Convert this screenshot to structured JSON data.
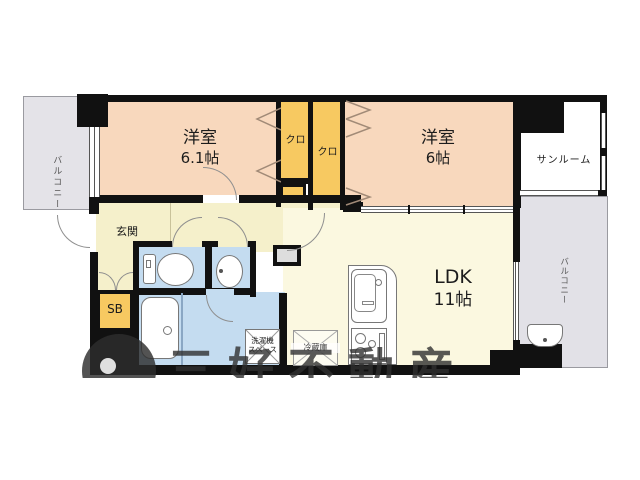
{
  "floorplan": {
    "balcony_left": {
      "label": "バルコニー"
    },
    "room1": {
      "label": "洋室",
      "size": "6.1帖"
    },
    "closet_left": {
      "label": "クロ"
    },
    "closet_right": {
      "label": "クロ"
    },
    "room2": {
      "label": "洋室",
      "size": "6帖"
    },
    "sunroom": {
      "label": "サンルーム"
    },
    "balcony_right": {
      "label": "バルコニー"
    },
    "genkan": {
      "label": "玄関"
    },
    "shoebox": {
      "label": "SB"
    },
    "ldk": {
      "label": "LDK",
      "size": "11帖"
    },
    "washer_space": {
      "line1": "洗濯機",
      "line2": "スペース"
    },
    "refrigerator": {
      "label": "冷蔵庫"
    },
    "watermark": {
      "text": "三好不動産"
    },
    "colors": {
      "room_peach": "#f8d8bd",
      "closet_orange": "#f7c961",
      "living_cream": "#fbf8e0",
      "hall_cream": "#f5f0cb",
      "wet_blue": "#c4dcf0",
      "balcony_gray": "#e4e3e8",
      "wall_black": "#111111"
    }
  }
}
